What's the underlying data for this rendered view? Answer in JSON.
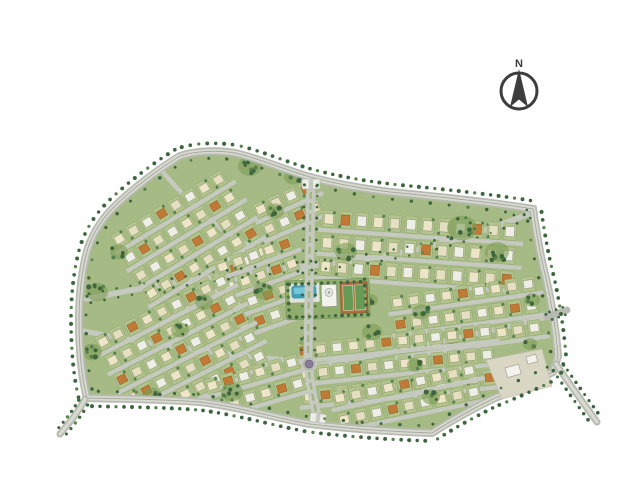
{
  "compass": {
    "label": "N"
  },
  "map": {
    "background": "#ffffff",
    "palette": {
      "lawn": "#a6ba85",
      "park_lawn": "#90ad6d",
      "lot": "#b2c38d",
      "lot_edge": "#8aa368",
      "street": "#c6c9bf",
      "road_outer": "#b7bab0",
      "road_inner": "#d8dad1",
      "road_center": "#a7aa9e",
      "tree_dark": "#3e663e",
      "tree_mid": "#55814b",
      "grove": "#7d9c55",
      "house_cream": "#ece5c8",
      "house_cream2": "#e3dfc0",
      "house_white": "#edeee6",
      "house_orange": "#c17a36",
      "pool": "#43a0b8",
      "pool_light": "#7ecddd",
      "deck": "#dfe3d8",
      "court_clay": "#b06f3e",
      "court_green": "#679a54",
      "building_white": "#f3f3ee",
      "building_edge": "#a3a399",
      "plaza": "#dad6c4",
      "median": "#9db77e",
      "roundabout_center": "#8a7c96",
      "compass": "#3d3d3d"
    },
    "features": [
      "tree-lined perimeter boulevard",
      "villa residential blocks",
      "central park",
      "swimming pool",
      "clubhouse",
      "sports courts",
      "roundabout",
      "north entrance gate",
      "south entrance gate",
      "south-east entrance plaza",
      "exit roads",
      "compass rose"
    ],
    "blocks": [
      {
        "x": 110,
        "y": 236,
        "rot": -31,
        "rows": 5,
        "cols": 8,
        "gx": 16.5,
        "gy": 21,
        "om": 5,
        "seed": 1
      },
      {
        "x": 214,
        "y": 262,
        "rot": -20,
        "rows": 4,
        "cols": 5,
        "gx": 16.5,
        "gy": 21,
        "om": 6,
        "seed": 2
      },
      {
        "x": 252,
        "y": 205,
        "rot": -24,
        "rows": 2,
        "cols": 4,
        "gx": 16.5,
        "gy": 21,
        "om": 6,
        "seed": 9
      },
      {
        "x": 323,
        "y": 210,
        "rot": 4,
        "rows": 3,
        "cols": 12,
        "gx": 16.5,
        "gy": 24,
        "lh": 17,
        "om": 8,
        "seed": 3
      },
      {
        "x": 390,
        "y": 296,
        "rot": -8,
        "rows": 3,
        "cols": 9,
        "gx": 16.5,
        "gy": 22,
        "om": 7,
        "seed": 4
      },
      {
        "x": 297,
        "y": 344,
        "rot": -6,
        "rows": 3,
        "cols": 12,
        "gx": 16.5,
        "gy": 23,
        "om": 5,
        "seed": 5
      },
      {
        "x": 94,
        "y": 338,
        "rot": -27,
        "rows": 5,
        "cols": 9,
        "gx": 16.5,
        "gy": 21,
        "om": 4,
        "seed": 6
      },
      {
        "x": 204,
        "y": 380,
        "rot": -16,
        "rows": 2,
        "cols": 6,
        "gx": 16.5,
        "gy": 22,
        "om": 5,
        "seed": 7
      },
      {
        "x": 332,
        "y": 392,
        "rot": -12,
        "rows": 2,
        "cols": 9,
        "gx": 16.5,
        "gy": 22,
        "om": 6,
        "seed": 8
      }
    ],
    "tree_lines": [
      {
        "path": "outline",
        "offset": 8,
        "spacing": 8,
        "r": 1.9,
        "side": 1,
        "phase": 4
      },
      {
        "path": "outline",
        "offset": -7,
        "spacing": 19,
        "r": 1.6,
        "side": 1,
        "phase": 10
      },
      {
        "path": "stub-bl",
        "offset": 5,
        "spacing": 7,
        "r": 1.6,
        "both": true
      },
      {
        "path": "stub-br",
        "offset": 6,
        "spacing": 7.5,
        "r": 1.7,
        "both": true
      },
      {
        "path": "stub-r",
        "offset": 4,
        "spacing": 7,
        "r": 1.3,
        "both": true
      },
      {
        "path": "blvd",
        "offset": 6.5,
        "spacing": 11,
        "r": 1.4,
        "both": true
      },
      {
        "path": "c1",
        "offset": 4.5,
        "spacing": 14,
        "r": 1.3,
        "both": true
      },
      {
        "path": "park",
        "offset": -2.5,
        "spacing": 6.5,
        "r": 1.7,
        "side": 1
      }
    ],
    "tree_clusters": [
      [
        250,
        166,
        7,
        10
      ],
      [
        293,
        177,
        4,
        7
      ],
      [
        346,
        252,
        6,
        9
      ],
      [
        263,
        291,
        5,
        8
      ],
      [
        462,
        228,
        10,
        13
      ],
      [
        497,
        252,
        7,
        10
      ],
      [
        532,
        300,
        4,
        6
      ],
      [
        421,
        312,
        4,
        7
      ],
      [
        97,
        292,
        6,
        9
      ],
      [
        92,
        352,
        5,
        8
      ],
      [
        152,
        396,
        5,
        8
      ],
      [
        232,
        392,
        6,
        9
      ],
      [
        372,
        332,
        5,
        8
      ],
      [
        431,
        397,
        4,
        7
      ],
      [
        204,
        302,
        4,
        7
      ],
      [
        119,
        252,
        4,
        7
      ],
      [
        530,
        344,
        3,
        5
      ],
      [
        306,
        341,
        3,
        5
      ],
      [
        371,
        300,
        3,
        5
      ],
      [
        275,
        211,
        4,
        7
      ],
      [
        180,
        330,
        4,
        7
      ],
      [
        415,
        365,
        4,
        6
      ]
    ]
  }
}
